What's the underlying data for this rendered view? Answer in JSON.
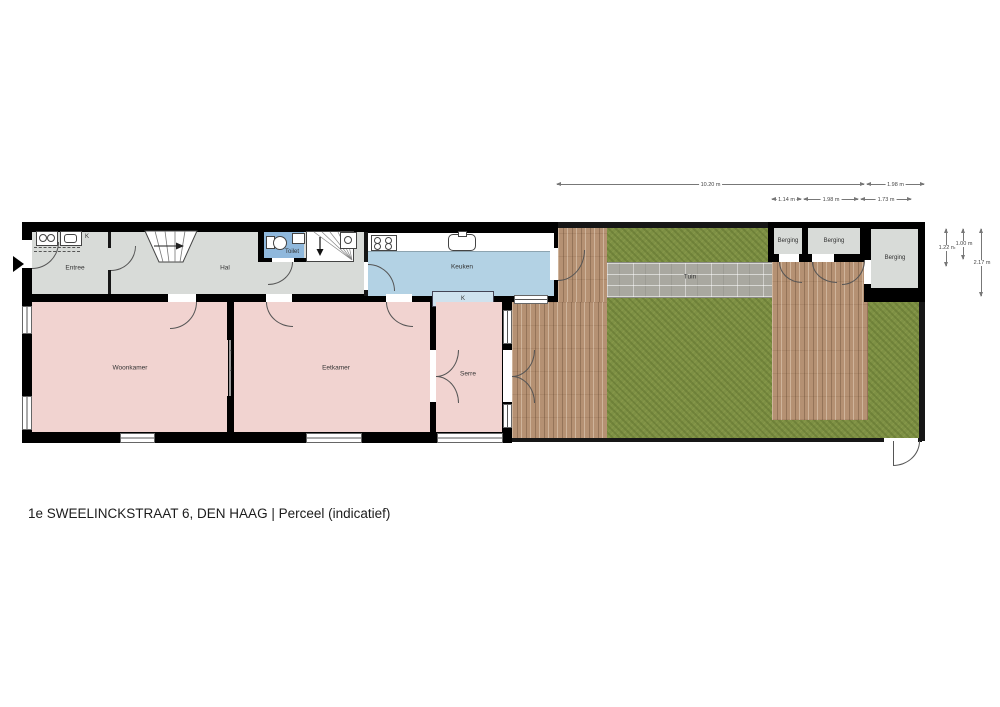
{
  "caption": "1e SWEELINCKSTRAAT 6, DEN HAAG  | Perceel  (indicatief)",
  "rooms": {
    "entree": "Entree",
    "hal": "Hal",
    "toilet": "Toilet",
    "keuken": "Keuken",
    "woonkamer": "Woonkamer",
    "eetkamer": "Eetkamer",
    "serre": "Serre",
    "tuin": "Tuin",
    "berging1": "Berging",
    "berging2": "Berging",
    "berging3": "Berging"
  },
  "closets": {
    "entree": "K",
    "divider_top": "K",
    "divider_bottom": "K",
    "keuken": "K"
  },
  "stairs_arrows": {
    "up": "↑",
    "down": "↓"
  },
  "dimensions": {
    "garden_width": "10.20 m",
    "garden_top_right": "1.98 m",
    "shed1_width": "1.14 m",
    "shed2_width": "1.98 m",
    "shed3_width": "1.73 m",
    "shed_depth_small": "1.22 m",
    "shed_depth_mid": "1.00 m",
    "shed_depth_large": "2.17 m"
  },
  "colors": {
    "wall": "#000000",
    "hall_gray": "#d8dbd8",
    "room_pink": "#f1d3d0",
    "kitchen_blue": "#b3d2e4",
    "toilet_blue": "#8fb8dc",
    "grass_green": "#7d9044",
    "deck_wood": "#b59173",
    "path_gray": "#a9a8a0"
  }
}
